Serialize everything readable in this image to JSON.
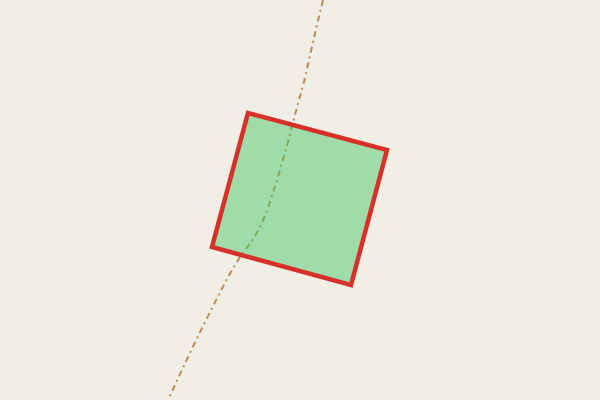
{
  "map": {
    "background_color": "#f1eee5",
    "track": {
      "name": "dashed-track",
      "color": "#b98d4f",
      "width": 2,
      "dash_pattern": "6 4 2 4",
      "path": "M 323,0 C 316,28 310,56 304,82 C 298,103 293,122 288,142 C 282,163 276,184 269,205 C 261,229 252,241 243,253 C 231,269 221,291 206,320 C 193,346 181,372 168,400"
    },
    "parcel": {
      "name": "highlighted-parcel",
      "fill_color": "rgba(60,197,95,0.45)",
      "stroke_color": "#d73028",
      "stroke_width": 4.5,
      "points": "248,113 387,150 351,285 212,247"
    }
  }
}
